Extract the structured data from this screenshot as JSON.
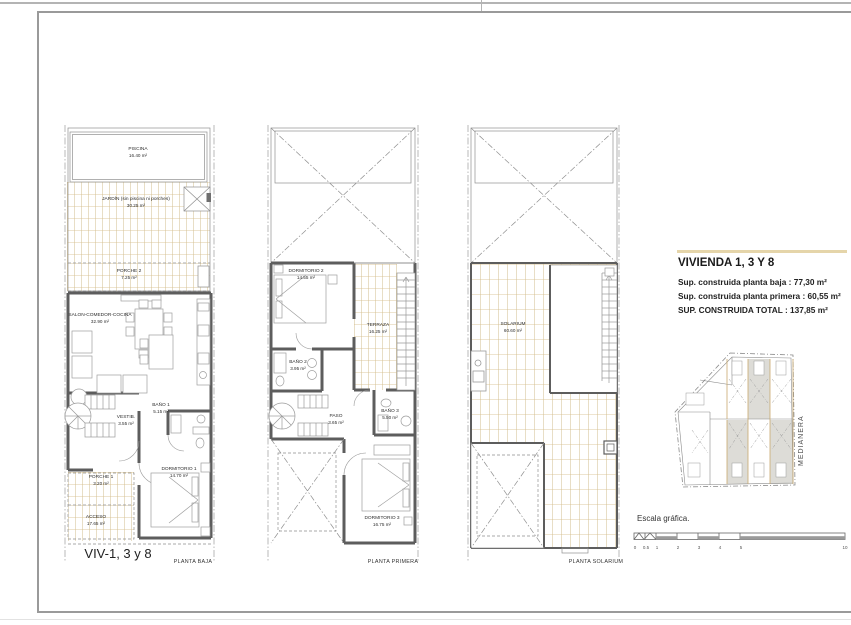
{
  "plan1": {
    "viv_label": "VIV-1, 3 y 8",
    "title": "PLANTA BAJA",
    "rooms": {
      "piscina": {
        "name": "PISCINA",
        "area": "16.40 m²"
      },
      "jardin": {
        "name": "JARDÍN (sin piscina ni porches)",
        "area": "30.25 m²"
      },
      "porche2": {
        "name": "PORCHE 2",
        "area": "7.25 m²"
      },
      "salon": {
        "name": "SALON-COMEDOR-COCINA",
        "area": "32.90 m²"
      },
      "bano1": {
        "name": "BAÑO 1",
        "area": "5.15 m²"
      },
      "vestib": {
        "name": "VESTIB.",
        "area": "3.55 m²"
      },
      "porche1": {
        "name": "PORCHE 1",
        "area": "3.20 m²"
      },
      "acceso": {
        "name": "ACCESO",
        "area": "17.65 m²"
      },
      "dorm1": {
        "name": "DORMITORIO 1",
        "area": "14.70 m²"
      }
    }
  },
  "plan2": {
    "title": "PLANTA PRIMERA",
    "rooms": {
      "dorm2": {
        "name": "DORMITORIO 2",
        "area": "14.55 m²"
      },
      "terraza": {
        "name": "TERRAZA",
        "area": "16.25 m²"
      },
      "bano2": {
        "name": "BAÑO 2",
        "area": "3.95 m²"
      },
      "paso": {
        "name": "PASO",
        "area": "3.65 m²"
      },
      "bano3": {
        "name": "BAÑO 3",
        "area": "5.50 m²"
      },
      "dorm3": {
        "name": "DORMITORIO 3",
        "area": "16.75 m²"
      }
    }
  },
  "plan3": {
    "title": "PLANTA SOLARIUM",
    "rooms": {
      "solarium": {
        "name": "SOLARIUM",
        "area": "60.60 m²"
      }
    }
  },
  "legend": {
    "title": "VIVIENDA 1, 3 Y 8",
    "line1": "Sup. construida planta baja : 77,30 m²",
    "line2": "Sup. construida planta primera : 60,55 m²",
    "line3": "SUP. CONSTRUIDA TOTAL : 137,85 m²",
    "medianera": "MEDIANERA"
  },
  "scale": {
    "caption": "Escala gráfica.",
    "ticks": [
      "0",
      "0.5",
      "1",
      "2",
      "3",
      "4",
      "5",
      "10"
    ]
  },
  "colors": {
    "wall": "#5d5d5d",
    "thin_line": "#8f8f8f",
    "hatch": "#d2bd8d",
    "accent_rule": "#e5d5aa",
    "highlight_unit": "#dddcd7"
  }
}
